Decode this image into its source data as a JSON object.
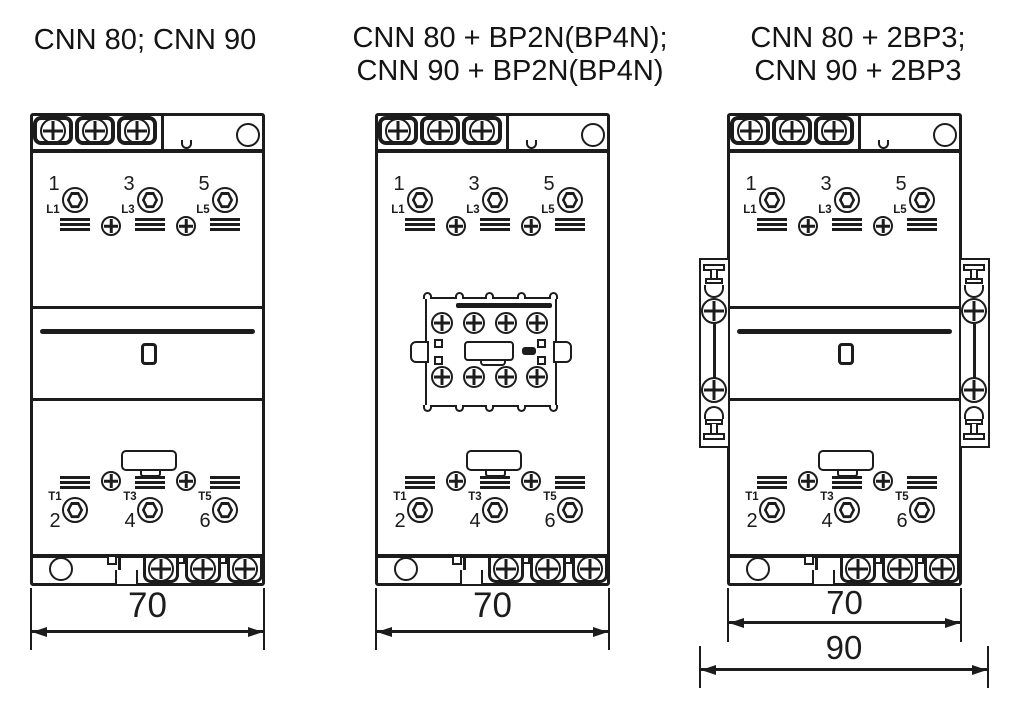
{
  "colors": {
    "ink": "#1c1c1c",
    "background": "#ffffff"
  },
  "diagrams": [
    {
      "title_lines": [
        "CNN 80; CNN 90"
      ],
      "dim_width": "70"
    },
    {
      "title_lines": [
        "CNN 80 + BP2N(BP4N);",
        "CNN 90 + BP2N(BP4N)"
      ],
      "dim_width": "70"
    },
    {
      "title_lines": [
        "CNN 80 + 2BP3;",
        "CNN 90 + 2BP3"
      ],
      "dim_width": "70",
      "dim_total": "90"
    }
  ],
  "poles": {
    "top_numbers": [
      "1",
      "3",
      "5"
    ],
    "top_terminals": [
      "L1",
      "L3",
      "L5"
    ],
    "bottom_terminals": [
      "T1",
      "T3",
      "T5"
    ],
    "bottom_numbers": [
      "2",
      "4",
      "6"
    ]
  },
  "icons": {
    "phillips_screw": "circle-with-cross",
    "hex_socket_terminal": "circle-with-hexagon",
    "wire_clamp": "triple-line-stack",
    "mounting_hole": "plain-circle"
  }
}
